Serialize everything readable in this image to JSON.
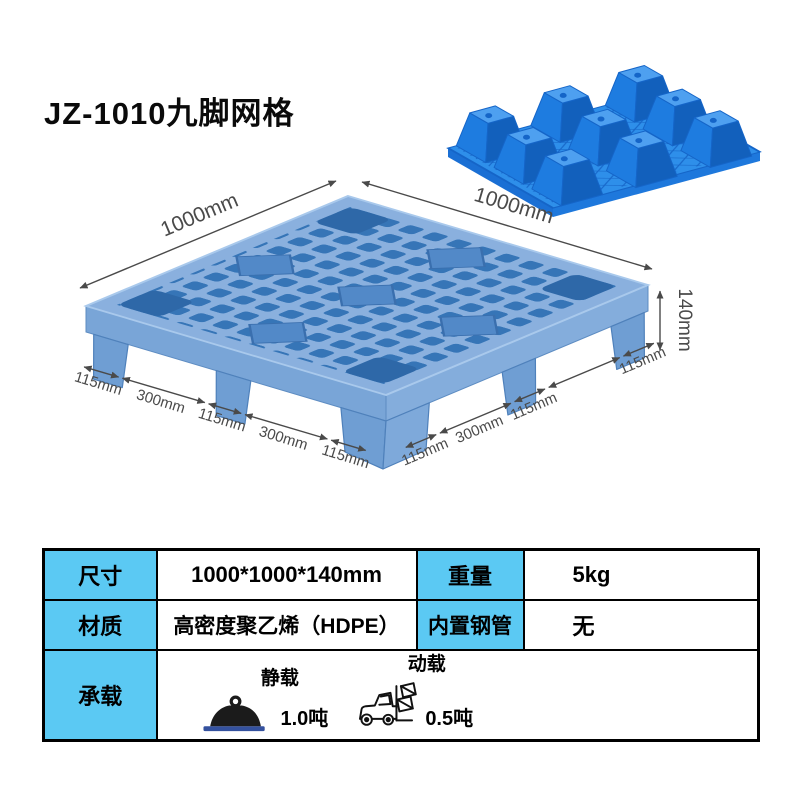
{
  "title": "JZ-1010九脚网格",
  "diagram": {
    "dim_top_left": "1000mm",
    "dim_top_right": "1000mm",
    "dim_height": "140mm",
    "front_left_dims": [
      "115mm",
      "300mm",
      "115mm",
      "300mm",
      "115mm"
    ],
    "front_right_dims": [
      "115mm",
      "300mm",
      "115mm"
    ],
    "right_foot_dim": "115mm",
    "pallet_deck_color": "#8AB0DE",
    "pallet_hole_color": "#3675B7",
    "photo_pallet_color": "#2E8FEA"
  },
  "table": {
    "header_bg": "#5BC9F3",
    "size_label": "尺寸",
    "size_value": "1000*1000*140mm",
    "weight_label": "重量",
    "weight_value": "5kg",
    "material_label": "材质",
    "material_value": "高密度聚乙烯（HDPE）",
    "pipe_label": "内置钢管",
    "pipe_value": "无",
    "load_label": "承载",
    "static_load_label": "静载",
    "static_load_value": "1.0吨",
    "dynamic_load_label": "动载",
    "dynamic_load_value": "0.5吨"
  }
}
